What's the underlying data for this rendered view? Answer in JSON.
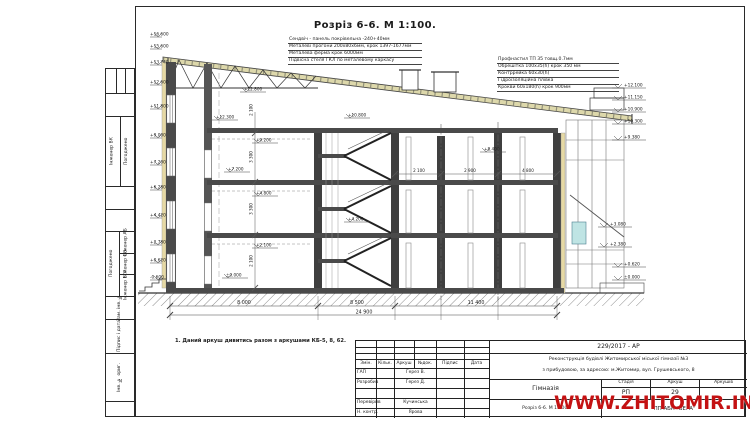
{
  "title": "Розріз 6-6.  М 1:100.",
  "notes_left": {
    "lines": [
      "Сендвіч - панель покрівельна -240+40мм",
      "Металеві прогони  200х80х6мм, крок 1397-1677мм",
      "Металева ферма крок 6000мм",
      "Підвісна стеля ГКЛ по металевому каркасу"
    ]
  },
  "notes_right": {
    "lines": [
      "Профнастил ТП 35 товщ.0.7мм",
      "Обрешітка 100х35(h) крок 350 мм",
      "Контррейка 60х30(h)",
      "Гідроізоляційна плівка",
      "Крокви 60х180(h) крок 900мм"
    ]
  },
  "footnote": "1.   Даний аркуш дивитись разом з аркушами КБ-5, 8, 62.",
  "drawing": {
    "axes": [
      "А",
      "Б",
      "Г",
      "Д",
      "Ж",
      "И"
    ],
    "span_dims": [
      "8 000",
      "8 500",
      "11 400"
    ],
    "total_dim": "24 900",
    "left_marks": [
      "+16.600",
      "+15.600",
      "+13.740",
      "+12.600",
      "+11.800",
      "+9.000",
      "+7.200",
      "+6.280",
      "+4.420",
      "+2.780",
      "+0.620",
      "-0.600"
    ],
    "right_marks": [
      "+12.100",
      "+11.150",
      "+10.900",
      "+10.300",
      "+9.380",
      "+3.080",
      "+2.380",
      "+0.620",
      "±0.000"
    ],
    "interior_marks": [
      "+12.800",
      "+12.300",
      "+10.800",
      "+9.200",
      "+8.400",
      "+7.200",
      "+4.800",
      "+4.200",
      "+2.100",
      "±0.000"
    ],
    "h_dims": [
      "2 100",
      "2 900",
      "4 800"
    ],
    "v_dims": [
      "2 100",
      "3 300",
      "3 300",
      "2 100"
    ]
  },
  "titleblock": {
    "doc_number": "229/2017 - АР",
    "project_line1": "Реконструкція будівлі Житомирської міської гімназії №3",
    "project_line2": "з прибудовою, за адресою: м.Житомир, вул. Грушевського, 8",
    "object_name": "Гімназія",
    "drawing_name": "Розріз 6-6.  М 1:100.",
    "stage_label": "Стадія",
    "sheet_label": "Аркуш",
    "sheets_label": "Аркушів",
    "stage": "РП",
    "sheet": "29",
    "company": "ПП АБК \"ВЕРА\"",
    "header": [
      "Змін.",
      "Кільк.",
      "Аркуш",
      "№док.",
      "Підпис",
      "Дата"
    ],
    "roles": [
      {
        "role": "ГАП",
        "name": "Герез В."
      },
      {
        "role": "Розробив",
        "name": "Герез Д."
      },
      {
        "role": "Перевірив",
        "name": "Кучинська"
      },
      {
        "role": "Н. контр.",
        "name": "Ярова"
      }
    ]
  },
  "margin": {
    "block1_name": "Інженер ВК",
    "block1_role": "Погоджено",
    "block2_role": "Погоджено",
    "block2_rows": [
      "Інженер АБ",
      "Інженер ОВ",
      "Інженер ЕТР"
    ],
    "zam": "Зам. інв. №",
    "pidpys": "Підпис і дата",
    "inv": "Інв. № ориг."
  },
  "watermark": "WWW.ZHITOMIR.INFO"
}
